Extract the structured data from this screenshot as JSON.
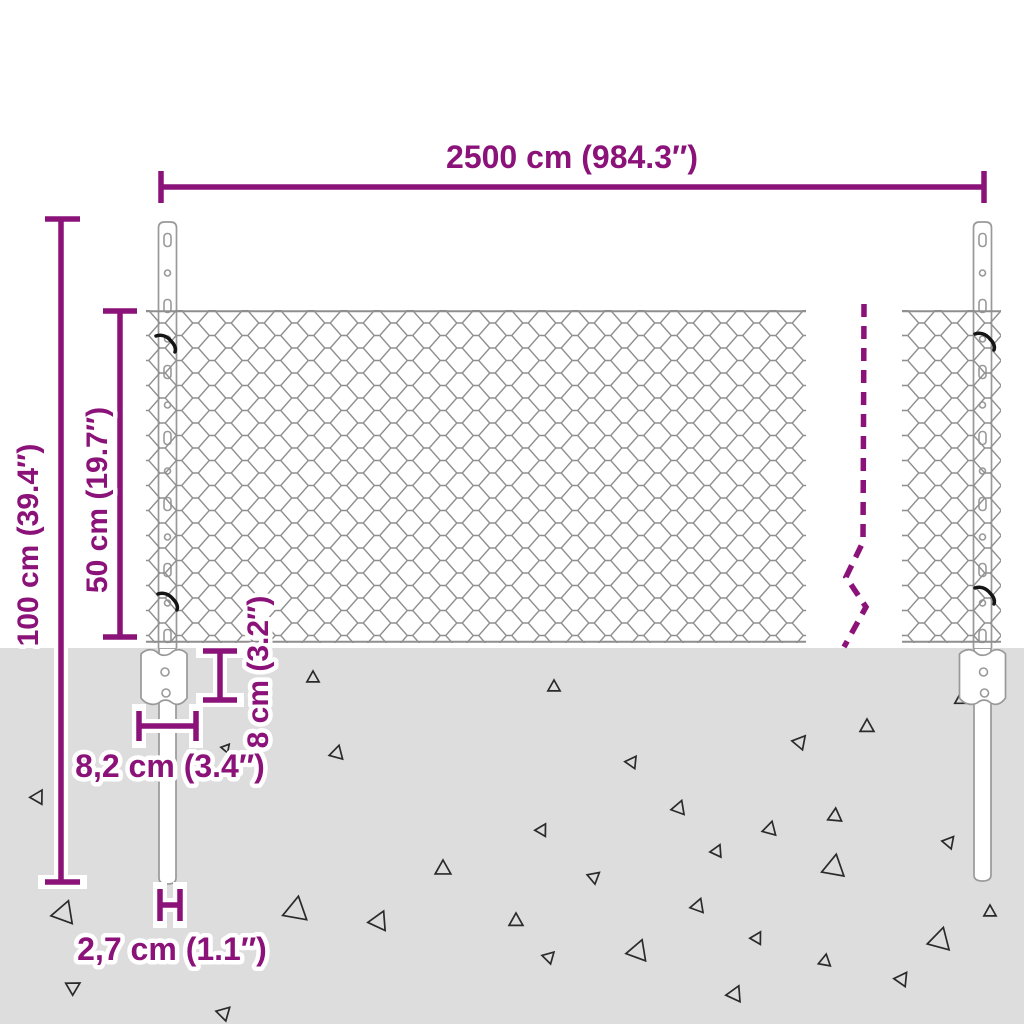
{
  "title": "Chain-link fence with posts — dimension diagram",
  "colors": {
    "dimension": "#8B1278",
    "halo": "#FFFFFF",
    "mesh": "#8F8F8F",
    "post": "#999999",
    "ground": "#DDDDDD",
    "triangle": "#2A2A2A",
    "tie": "#151515"
  },
  "dimensions": {
    "fence_width": {
      "label": "2500 cm (984.3″)"
    },
    "post_height": {
      "label": "100 cm (39.4″)"
    },
    "mesh_height": {
      "label": "50 cm (19.7″)"
    },
    "anchor_plate_depth": {
      "label": "8 cm (3.2″)"
    },
    "anchor_plate_width": {
      "label": "8,2 cm (3.4″)"
    },
    "post_diameter": {
      "label": "2,7 cm (1.1″)"
    }
  },
  "decor": {
    "posts_cx": [
      167.5,
      982.5
    ],
    "post_features": {
      "start_y": 240,
      "step": 33,
      "count": 13
    },
    "ties": [
      {
        "x": 156,
        "y": 336
      },
      {
        "x": 158,
        "y": 594
      },
      {
        "x": 975,
        "y": 334
      },
      {
        "x": 975,
        "y": 588
      }
    ],
    "triangles": [
      {
        "x": 313,
        "y": 678,
        "s": 7,
        "r": 0
      },
      {
        "x": 337,
        "y": 753,
        "s": 8,
        "r": 15
      },
      {
        "x": 226,
        "y": 748,
        "s": 5,
        "r": 40
      },
      {
        "x": 38,
        "y": 797,
        "s": 8,
        "r": 30
      },
      {
        "x": 64,
        "y": 913,
        "s": 13,
        "r": 20
      },
      {
        "x": 163,
        "y": 957,
        "s": 6,
        "r": 105
      },
      {
        "x": 296,
        "y": 910,
        "s": 14,
        "r": 10
      },
      {
        "x": 379,
        "y": 921,
        "s": 11,
        "r": 25
      },
      {
        "x": 443,
        "y": 869,
        "s": 9,
        "r": 0
      },
      {
        "x": 224,
        "y": 1013,
        "s": 8,
        "r": 45
      },
      {
        "x": 73,
        "y": 987,
        "s": 8,
        "r": 60
      },
      {
        "x": 554,
        "y": 687,
        "s": 7,
        "r": 0
      },
      {
        "x": 632,
        "y": 762,
        "s": 7,
        "r": 35
      },
      {
        "x": 679,
        "y": 808,
        "s": 8,
        "r": 20
      },
      {
        "x": 800,
        "y": 742,
        "s": 8,
        "r": 40
      },
      {
        "x": 867,
        "y": 727,
        "s": 8,
        "r": 0
      },
      {
        "x": 542,
        "y": 830,
        "s": 7,
        "r": 30
      },
      {
        "x": 770,
        "y": 829,
        "s": 8,
        "r": 15
      },
      {
        "x": 835,
        "y": 816,
        "s": 8,
        "r": 5
      },
      {
        "x": 717,
        "y": 851,
        "s": 7,
        "r": 25
      },
      {
        "x": 949,
        "y": 842,
        "s": 7,
        "r": 40
      },
      {
        "x": 834,
        "y": 867,
        "s": 13,
        "r": 10
      },
      {
        "x": 594,
        "y": 877,
        "s": 7,
        "r": 50
      },
      {
        "x": 698,
        "y": 906,
        "s": 8,
        "r": 20
      },
      {
        "x": 516,
        "y": 921,
        "s": 8,
        "r": 0
      },
      {
        "x": 757,
        "y": 938,
        "s": 7,
        "r": 30
      },
      {
        "x": 940,
        "y": 940,
        "s": 13,
        "r": 15
      },
      {
        "x": 549,
        "y": 957,
        "s": 7,
        "r": 45
      },
      {
        "x": 638,
        "y": 951,
        "s": 12,
        "r": 20
      },
      {
        "x": 825,
        "y": 961,
        "s": 7,
        "r": 10
      },
      {
        "x": 902,
        "y": 979,
        "s": 8,
        "r": 35
      },
      {
        "x": 735,
        "y": 994,
        "s": 9,
        "r": 25
      },
      {
        "x": 990,
        "y": 912,
        "s": 7,
        "r": 0
      },
      {
        "x": 960,
        "y": 700,
        "s": 6,
        "r": 0
      }
    ]
  }
}
